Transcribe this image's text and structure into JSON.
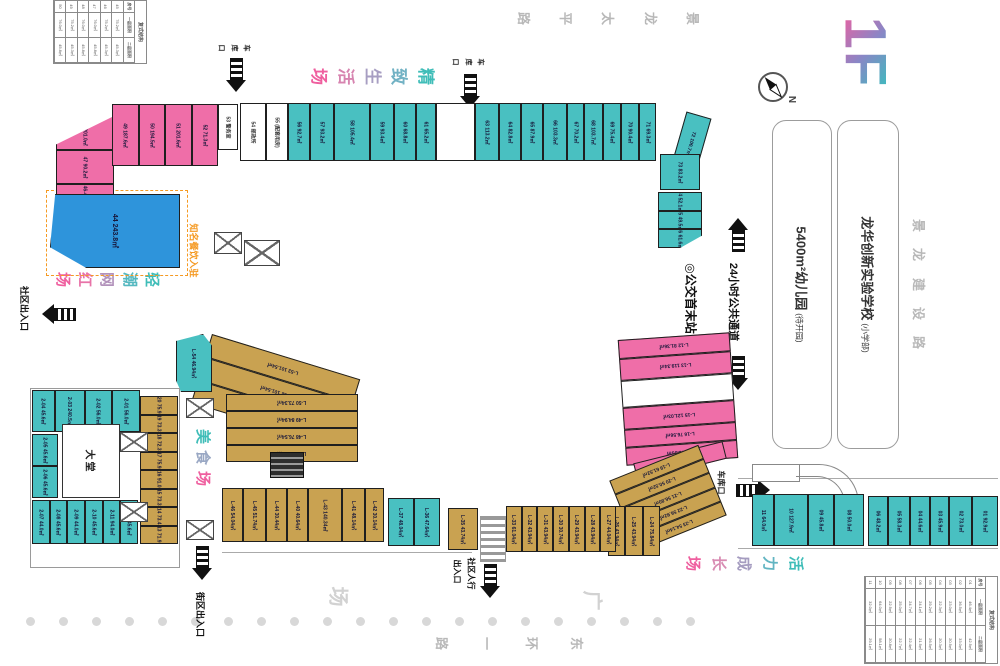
{
  "title": {
    "floor": "1F"
  },
  "compass": {
    "label": "N"
  },
  "roads": {
    "top": [
      "景",
      "龙",
      "太",
      "平",
      "路"
    ],
    "right": [
      "景",
      "龙",
      "建",
      "设",
      "路"
    ],
    "bottom": [
      "东",
      "环",
      "一",
      "路"
    ]
  },
  "plaza": {
    "char_guang": "广",
    "char_chang": "场"
  },
  "zones": {
    "refined": {
      "chars": [
        "精",
        "致",
        "生",
        "活",
        "场"
      ],
      "colors": [
        "#3fbdb8",
        "#72b2c4",
        "#a79ec2",
        "#d784b0",
        "#ef5f9f"
      ]
    },
    "trendy_top": {
      "chars": [
        "轻",
        "潮",
        "网",
        "红",
        "场"
      ],
      "colors": [
        "#3fbdb8",
        "#55b8c0",
        "#b292bb",
        "#e873a8",
        "#ef5f9f"
      ]
    },
    "trendy_bottom": {
      "chars": [
        "轻",
        "潮",
        "网",
        "红",
        "场"
      ],
      "colors": [
        "#3fbdb8",
        "#55b8c0",
        "#b292bb",
        "#e873a8",
        "#ef5f9f"
      ]
    },
    "food": {
      "chars": [
        "美",
        "食",
        "场"
      ],
      "colors": [
        "#3fbdb8",
        "#9aa8c4",
        "#ef5f9f"
      ]
    },
    "vitality": {
      "chars": [
        "活",
        "力",
        "成",
        "长",
        "场"
      ],
      "colors": [
        "#3fbdb8",
        "#62b5c2",
        "#a59cc0",
        "#d88bb2",
        "#ef5f9f"
      ]
    }
  },
  "landmarks": {
    "kindergarten": {
      "name": "5400m²幼儿园",
      "note": "(待开园)"
    },
    "school": {
      "name": "龙华创新实验学校",
      "note": "(小学部)"
    }
  },
  "callout": {
    "text": "知名餐饮入驻"
  },
  "entrances": {
    "garage_top1": "车库口",
    "garage_top2": "车库口",
    "garage_right": "车库口",
    "community_left": "社区出入口",
    "block_bottom": "街区出入口",
    "pedestrian_col1": "社区人行",
    "pedestrian_col2": "出入口",
    "bus_terminal": "◎公交首末站",
    "passage_24h": "24小时公共通道"
  },
  "lobby": {
    "label": "大堂"
  },
  "clusters": {
    "top_left_rows": [
      {
        "n": "48",
        "a": "201.0㎡"
      },
      {
        "n": "47",
        "a": "90.2㎡"
      },
      {
        "n": "46-45",
        "a": "100.4㎡"
      }
    ],
    "top_left_cols": [
      {
        "n": "49",
        "a": "187.6㎡"
      },
      {
        "n": "50",
        "a": "194.5㎡"
      },
      {
        "n": "51",
        "a": "201.6㎡"
      },
      {
        "n": "52",
        "a": "71.3㎡"
      }
    ],
    "unit_53": [
      {
        "n": "53",
        "a": "警务室",
        "white": true
      }
    ],
    "unit_44": [
      {
        "n": "44",
        "a": "243.8㎡"
      }
    ],
    "top_strip": [
      {
        "n": "54",
        "a": "邮政所",
        "white": true,
        "w": 26
      },
      {
        "n": "55",
        "a": "(配套用房)",
        "white": true,
        "w": 22
      },
      {
        "n": "56",
        "a": "92.7㎡",
        "w": 22
      },
      {
        "n": "57",
        "a": "93.2㎡",
        "w": 24
      },
      {
        "n": "58",
        "a": "105.4㎡",
        "w": 38
      },
      {
        "n": "59",
        "a": "93.4㎡",
        "w": 24
      },
      {
        "n": "60",
        "a": "68.8㎡",
        "w": 22
      },
      {
        "n": "61",
        "a": "65.2㎡",
        "w": 20
      },
      {
        "n": "",
        "a": "",
        "white": true,
        "w": 40
      },
      {
        "n": "63",
        "a": "113.2㎡",
        "w": 24
      },
      {
        "n": "64",
        "a": "82.8㎡",
        "w": 22
      },
      {
        "n": "65",
        "a": "87.9㎡",
        "w": 22
      },
      {
        "n": "66",
        "a": "103.3㎡",
        "w": 24
      },
      {
        "n": "67",
        "a": "70.2㎡",
        "w": 17
      },
      {
        "n": "68",
        "a": "103.7㎡",
        "w": 18
      },
      {
        "n": "69",
        "a": "75.4㎡",
        "w": 18
      },
      {
        "n": "70",
        "a": "90.4㎡",
        "w": 18
      },
      {
        "n": "71",
        "a": "69.3㎡",
        "w": 16
      }
    ],
    "unit_72": [
      {
        "n": "72",
        "a": "100.7㎡"
      }
    ],
    "unit_73": [
      {
        "n": "73",
        "a": "83.2㎡"
      }
    ],
    "right_col": [
      {
        "n": "74",
        "a": "52.1㎡"
      },
      {
        "n": "75",
        "a": "49.5㎡"
      },
      {
        "n": "76",
        "a": "61.6㎡"
      }
    ],
    "right_pink": [
      {
        "n": "L-12",
        "a": "81.36㎡",
        "w": 16
      },
      {
        "n": "L-13",
        "a": "119.34㎡",
        "w": 18
      },
      {
        "n": "",
        "a": "",
        "white": true,
        "w": 24
      },
      {
        "n": "L-15",
        "a": "121.03㎡",
        "w": 18
      },
      {
        "n": "L-16",
        "a": "76.56㎡",
        "w": 15
      },
      {
        "n": "L-17",
        "a": "81.93㎡",
        "w": 15
      }
    ],
    "unit_l18": [
      {
        "n": "L-18",
        "a": "91.56㎡"
      }
    ],
    "diag_tan": [
      {
        "n": "L-19",
        "a": "61.52㎡"
      },
      {
        "n": "L-20",
        "a": "50.52㎡"
      },
      {
        "n": "L-21",
        "a": "56.80㎡"
      },
      {
        "n": "L-22",
        "a": "56.92㎡"
      },
      {
        "n": "L-23",
        "a": "54.14㎡"
      }
    ],
    "small_tan_row": [
      {
        "n": "L-26",
        "a": "43.94㎡"
      },
      {
        "n": "L-25",
        "a": "43.94㎡"
      },
      {
        "n": "L-24",
        "a": "75.84㎡"
      }
    ],
    "bottom_tan_a": [
      {
        "n": "L-35",
        "a": "43.74㎡"
      }
    ],
    "bottom_tan_b": [
      {
        "n": "L-33",
        "a": "61.04㎡"
      },
      {
        "n": "L-32",
        "a": "43.94㎡"
      },
      {
        "n": "L-31",
        "a": "43.94㎡"
      },
      {
        "n": "L-30",
        "a": "30.74㎡"
      },
      {
        "n": "L-29",
        "a": "43.94㎡"
      },
      {
        "n": "L-28",
        "a": "43.94㎡"
      },
      {
        "n": "L-27",
        "a": "44.04㎡"
      }
    ],
    "teal_pair": [
      {
        "n": "L-37",
        "a": "48.04㎡"
      },
      {
        "n": "L-36",
        "a": "47.64㎡"
      }
    ],
    "mid_tan": [
      {
        "n": "L-46",
        "a": "54.04㎡",
        "w": 18
      },
      {
        "n": "L-45",
        "a": "51.74㎡",
        "w": 20
      },
      {
        "n": "L-44",
        "a": "30.44㎡",
        "w": 18
      },
      {
        "n": "L-40",
        "a": "40.64㎡",
        "w": 18
      },
      {
        "n": "L-43",
        "a": "140.34㎡",
        "w": 30
      },
      {
        "n": "L-41",
        "a": "48.14㎡",
        "w": 20
      },
      {
        "n": "L-42",
        "a": "30.14㎡",
        "w": 16
      }
    ],
    "food_diag": [
      {
        "n": "L-53",
        "a": "101.54㎡"
      },
      {
        "n": "L-52",
        "a": "101.54㎡"
      },
      {
        "n": "L-51",
        "a": "101.64㎡"
      }
    ],
    "food_rows": [
      {
        "n": "L-50",
        "a": "73.34㎡"
      },
      {
        "n": "L-49",
        "a": "84.94㎡"
      },
      {
        "n": "L-48",
        "a": "76.54㎡"
      },
      {
        "n": "L-47",
        "a": "76.34㎡"
      }
    ],
    "unit_l54": [
      {
        "n": "L-54",
        "a": "46.94㎡"
      }
    ],
    "lobby_top_row": [
      {
        "n": "2-04",
        "a": "45.6㎡",
        "w": 22
      },
      {
        "n": "2-03",
        "a": "240.5㎡",
        "w": 30
      },
      {
        "n": "2-02",
        "a": "56.0㎡",
        "w": 26
      },
      {
        "n": "2-01",
        "a": "56.0㎡",
        "w": 28
      }
    ],
    "lobby_left_col": [
      {
        "n": "2-05",
        "a": "45.6㎡"
      },
      {
        "n": "2-06",
        "a": "45.6㎡"
      }
    ],
    "lobby_bottom_row": [
      {
        "n": "2-07",
        "a": "44.0㎡"
      },
      {
        "n": "2-08",
        "a": "45.6㎡"
      },
      {
        "n": "2-09",
        "a": "44.0㎡"
      },
      {
        "n": "2-10",
        "a": "45.6㎡"
      },
      {
        "n": "2-11",
        "a": "94.0㎡"
      },
      {
        "n": "2-12",
        "a": "45.6㎡"
      }
    ],
    "lobby_tan_col": [
      {
        "n": "2-20",
        "a": "75.9㎡"
      },
      {
        "n": "2-19",
        "a": "73.3㎡"
      },
      {
        "n": "2-18",
        "a": "72.3㎡"
      },
      {
        "n": "2-17",
        "a": "75.9㎡"
      },
      {
        "n": "2-16",
        "a": "91.0㎡"
      },
      {
        "n": "2-15",
        "a": "73.3㎡"
      },
      {
        "n": "2-14",
        "a": "73.4㎡"
      },
      {
        "n": "2-13",
        "a": "71.9㎡"
      }
    ],
    "growth_a": [
      {
        "n": "11",
        "a": "64.0㎡",
        "w": 22
      },
      {
        "n": "10",
        "a": "127.9㎡",
        "w": 34
      },
      {
        "n": "09",
        "a": "45.8㎡",
        "w": 26
      },
      {
        "n": "08",
        "a": "50.0㎡",
        "w": 30
      }
    ],
    "growth_b": [
      {
        "n": "06",
        "a": "48.2㎡",
        "w": 20
      },
      {
        "n": "05",
        "a": "58.3㎡",
        "w": 22
      },
      {
        "n": "04",
        "a": "44.6㎡",
        "w": 20
      },
      {
        "n": "03",
        "a": "45.9㎡",
        "w": 18
      },
      {
        "n": "02",
        "a": "73.0㎡",
        "w": 24
      },
      {
        "n": "01",
        "a": "92.9㎡",
        "w": 26
      }
    ]
  },
  "legends": {
    "top": {
      "title": "复式结构",
      "cols": [
        "房号",
        "一层面积",
        "二层面积"
      ],
      "rows": [
        [
          "45",
          "75.2㎡",
          "45.3㎡"
        ],
        [
          "46",
          "75.2㎡",
          "45.3㎡"
        ],
        [
          "47",
          "76.0㎡",
          "45.8㎡"
        ],
        [
          "48",
          "76.0㎡",
          "45.8㎡"
        ],
        [
          "49",
          "75.2㎡",
          "45.3㎡"
        ],
        [
          "50",
          "76.0㎡",
          "45.8㎡"
        ]
      ]
    },
    "bottom": {
      "title": "复式结构",
      "cols": [
        "房号",
        "一层面积",
        "二层面积"
      ],
      "rows": [
        [
          "01",
          "46.4㎡",
          "42.9㎡"
        ],
        [
          "02",
          "36.5㎡",
          "33.0㎡"
        ],
        [
          "03",
          "23.0㎡",
          "20.9㎡"
        ],
        [
          "04",
          "22.3㎡",
          "20.3㎡"
        ],
        [
          "05",
          "29.2㎡",
          "26.5㎡"
        ],
        [
          "06",
          "24.1㎡",
          "21.9㎡"
        ],
        [
          "07",
          "24.7㎡",
          "22.4㎡"
        ],
        [
          "08",
          "25.0㎡",
          "22.7㎡"
        ],
        [
          "09",
          "22.9㎡",
          "20.8㎡"
        ],
        [
          "10",
          "64.0㎡",
          "58.1㎡"
        ],
        [
          "11",
          "32.0㎡",
          "29.1㎡"
        ]
      ]
    }
  },
  "trees": {
    "count": 21
  },
  "colors": {
    "pink": "#ef6ea8",
    "teal": "#49c0c1",
    "tan": "#c9a251",
    "blue": "#2e94db",
    "orange": "#f59a23",
    "road_gray": "#b8b8b8",
    "plaza_gray": "#d2d2d2"
  }
}
